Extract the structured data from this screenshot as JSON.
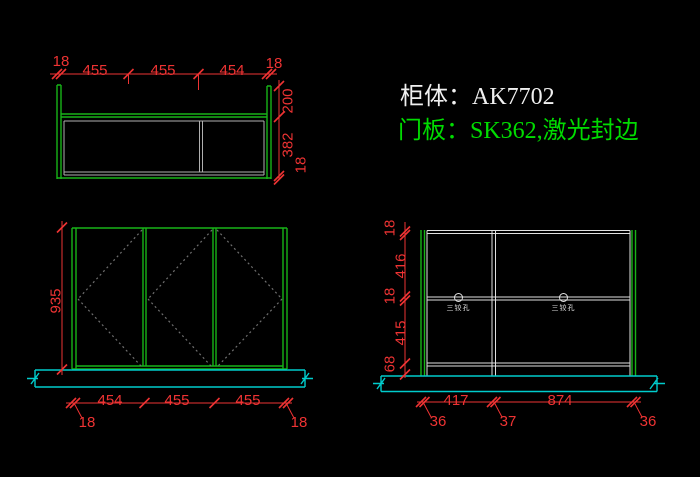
{
  "colors": {
    "background": "#000000",
    "outline_green": "#18b418",
    "dimension_red": "#ee3333",
    "baseline_cyan": "#00cccc",
    "detail_white": "#e0e0e0",
    "detail_gray": "#b0b0b0",
    "dash_gray": "#6f6f6f",
    "title_white": "#f0f0f0",
    "title_green": "#00dc00"
  },
  "title_block": {
    "cabinet_line": "柜体：AK7702",
    "door_line": "门板：SK362,激光封边"
  },
  "top_view": {
    "h_dims": [
      "18",
      "455",
      "455",
      "454",
      "18"
    ],
    "v_dims": [
      "200",
      "382",
      "18"
    ]
  },
  "front_view": {
    "height_dim": "935",
    "h_dims": [
      "454",
      "455",
      "455"
    ],
    "end_dims": [
      "18",
      "18"
    ]
  },
  "internal_view": {
    "v_dims": [
      "18",
      "416",
      "18",
      "415",
      "68"
    ],
    "h_dims": [
      "417",
      "874"
    ],
    "offset_dims": [
      "36",
      "37",
      "36"
    ],
    "hole_labels": [
      "三铰孔",
      "三铰孔"
    ]
  }
}
